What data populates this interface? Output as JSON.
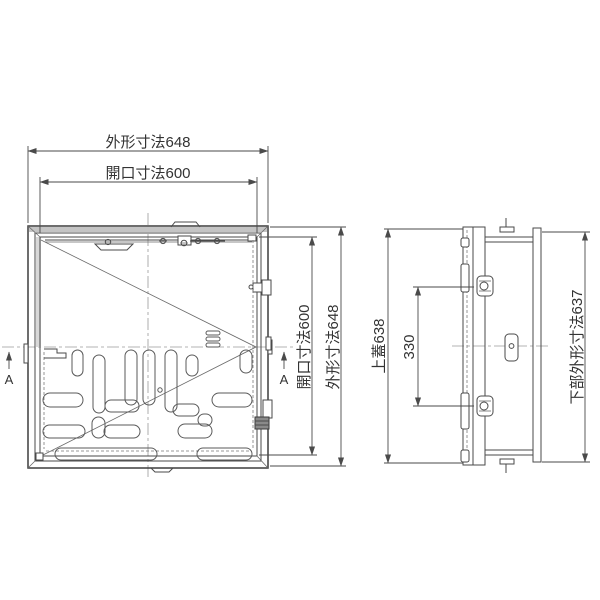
{
  "colors": {
    "background": "#ffffff",
    "line": "#4a4a4a",
    "centerline": "#9a9a9a",
    "text": "#333333"
  },
  "plan_view": {
    "dim_outer_width": {
      "label": "外形寸法648",
      "value": 648
    },
    "dim_opening_width": {
      "label": "開口寸法600",
      "value": 600
    },
    "dim_opening_height": {
      "label": "開口寸法600",
      "value": 600
    },
    "dim_outer_height": {
      "label": "外形寸法648",
      "value": 648
    },
    "section_marker_left": "A",
    "section_marker_right": "A"
  },
  "side_view": {
    "dim_top_lid": {
      "label": "上蓋638",
      "value": 638
    },
    "dim_hinge_pitch": {
      "label": "330",
      "value": 330
    },
    "dim_lower_outer": {
      "label": "下部外形寸法637",
      "value": 637
    }
  }
}
